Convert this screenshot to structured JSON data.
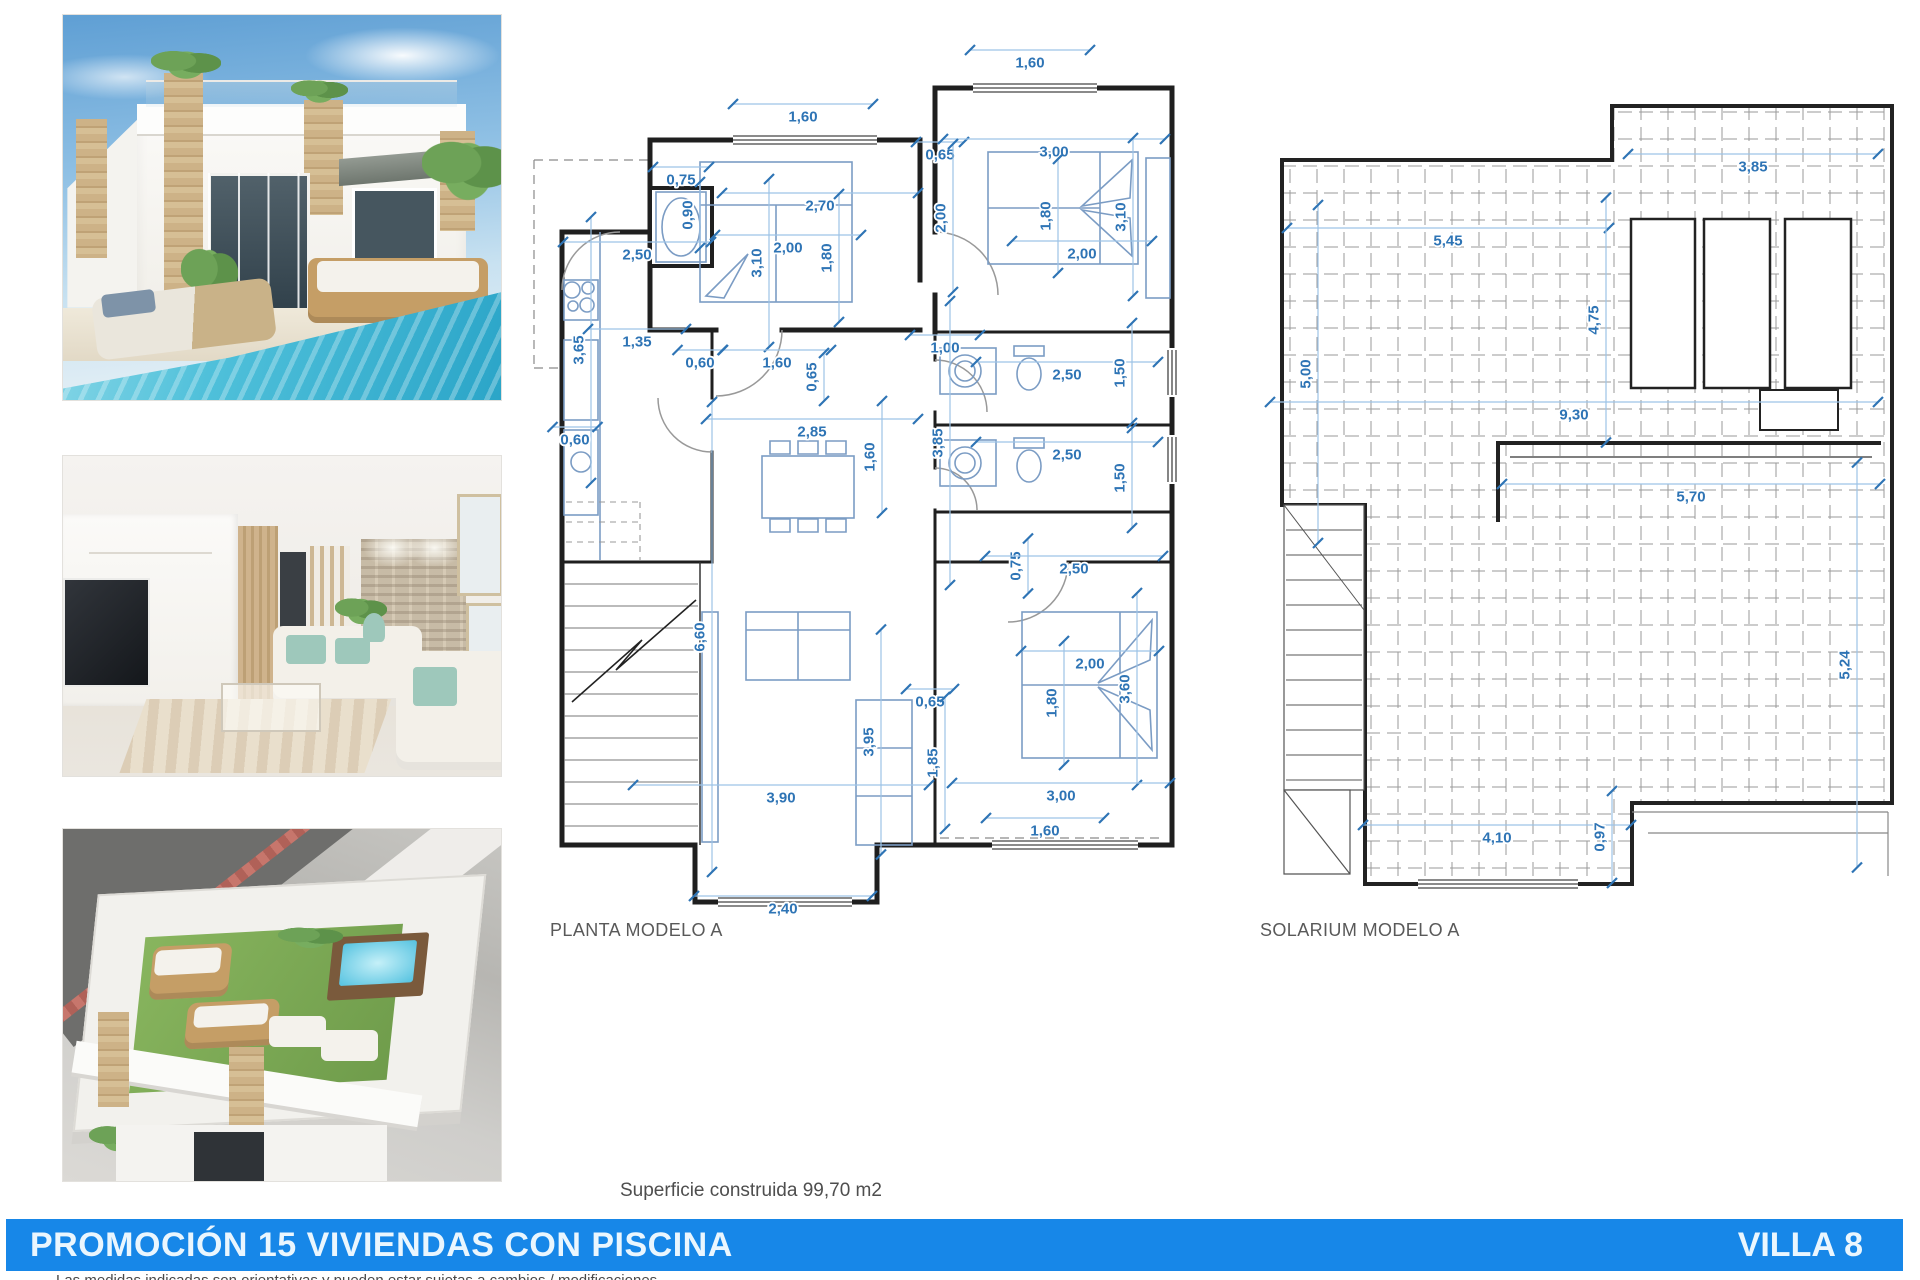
{
  "planta": {
    "label": "PLANTA MODELO A",
    "dims": [
      {
        "v": "1,60",
        "x": 803,
        "y": 117,
        "r": 0,
        "len": 140
      },
      {
        "v": "1,60",
        "x": 1030,
        "y": 63,
        "r": 0,
        "len": 120
      },
      {
        "v": "0,75",
        "x": 681,
        "y": 180,
        "r": 0,
        "len": 56
      },
      {
        "v": "0,90",
        "x": 688,
        "y": 215,
        "r": 1,
        "len": 66
      },
      {
        "v": "2,70",
        "x": 820,
        "y": 206,
        "r": 0,
        "len": 196
      },
      {
        "v": "2,00",
        "x": 788,
        "y": 248,
        "r": 0,
        "len": 146
      },
      {
        "v": "3,10",
        "x": 757,
        "y": 263,
        "r": 1,
        "len": 168
      },
      {
        "v": "1,80",
        "x": 827,
        "y": 258,
        "r": 1,
        "len": 128
      },
      {
        "v": "0,65",
        "x": 940,
        "y": 155,
        "r": 0,
        "len": 48
      },
      {
        "v": "3,00",
        "x": 1054,
        "y": 152,
        "r": 0,
        "len": 222
      },
      {
        "v": "2,00",
        "x": 941,
        "y": 218,
        "r": 1,
        "len": 148
      },
      {
        "v": "1,80",
        "x": 1046,
        "y": 216,
        "r": 1,
        "len": 114
      },
      {
        "v": "3,10",
        "x": 1121,
        "y": 217,
        "r": 1,
        "len": 158
      },
      {
        "v": "2,00",
        "x": 1082,
        "y": 254,
        "r": 0,
        "len": 140
      },
      {
        "v": "2,50",
        "x": 637,
        "y": 255,
        "r": 0,
        "len": 148
      },
      {
        "v": "3,65",
        "x": 579,
        "y": 350,
        "r": 1,
        "len": 266
      },
      {
        "v": "1,35",
        "x": 637,
        "y": 342,
        "r": 0,
        "len": 98
      },
      {
        "v": "0,60",
        "x": 700,
        "y": 363,
        "r": 0,
        "len": 45
      },
      {
        "v": "1,60",
        "x": 777,
        "y": 363,
        "r": 0,
        "len": 108
      },
      {
        "v": "0,65",
        "x": 812,
        "y": 377,
        "r": 1,
        "len": 48
      },
      {
        "v": "1,00",
        "x": 945,
        "y": 348,
        "r": 0,
        "len": 70
      },
      {
        "v": "2,85",
        "x": 812,
        "y": 432,
        "r": 0,
        "len": 212
      },
      {
        "v": "1,60",
        "x": 870,
        "y": 457,
        "r": 1,
        "len": 112
      },
      {
        "v": "3,85",
        "x": 938,
        "y": 443,
        "r": 1,
        "len": 284
      },
      {
        "v": "0,60",
        "x": 575,
        "y": 440,
        "r": 0,
        "len": 45
      },
      {
        "v": "2,50",
        "x": 1067,
        "y": 375,
        "r": 0,
        "len": 182
      },
      {
        "v": "1,50",
        "x": 1120,
        "y": 373,
        "r": 1,
        "len": 100
      },
      {
        "v": "2,50",
        "x": 1067,
        "y": 455,
        "r": 0,
        "len": 182
      },
      {
        "v": "1,50",
        "x": 1120,
        "y": 478,
        "r": 1,
        "len": 100
      },
      {
        "v": "0,75",
        "x": 1016,
        "y": 566,
        "r": 1,
        "len": 55
      },
      {
        "v": "2,50",
        "x": 1074,
        "y": 569,
        "r": 0,
        "len": 178
      },
      {
        "v": "6,60",
        "x": 700,
        "y": 637,
        "r": 1,
        "len": 470
      },
      {
        "v": "2,00",
        "x": 1090,
        "y": 664,
        "r": 0,
        "len": 138
      },
      {
        "v": "3,60",
        "x": 1125,
        "y": 689,
        "r": 1,
        "len": 192
      },
      {
        "v": "1,80",
        "x": 1052,
        "y": 703,
        "r": 1,
        "len": 124
      },
      {
        "v": "0,65",
        "x": 930,
        "y": 702,
        "r": 0,
        "len": 48
      },
      {
        "v": "3,95",
        "x": 869,
        "y": 742,
        "r": 1,
        "len": 225
      },
      {
        "v": "1,85",
        "x": 933,
        "y": 763,
        "r": 1,
        "len": 132
      },
      {
        "v": "3,00",
        "x": 1061,
        "y": 796,
        "r": 0,
        "len": 218
      },
      {
        "v": "3,90",
        "x": 781,
        "y": 798,
        "r": 0,
        "len": 296
      },
      {
        "v": "1,60",
        "x": 1045,
        "y": 831,
        "r": 0,
        "len": 118
      },
      {
        "v": "2,40",
        "x": 783,
        "y": 909,
        "r": 0,
        "len": 178
      }
    ]
  },
  "solarium": {
    "label": "SOLARIUM MODELO A",
    "dims": [
      {
        "v": "3,85",
        "x": 1753,
        "y": 167,
        "r": 0,
        "len": 250
      },
      {
        "v": "5,45",
        "x": 1448,
        "y": 241,
        "r": 0,
        "len": 322
      },
      {
        "v": "5,00",
        "x": 1306,
        "y": 374,
        "r": 1,
        "len": 338
      },
      {
        "v": "4,75",
        "x": 1594,
        "y": 320,
        "r": 1,
        "len": 245
      },
      {
        "v": "9,30",
        "x": 1574,
        "y": 415,
        "r": 0,
        "len": 608
      },
      {
        "v": "5,70",
        "x": 1691,
        "y": 497,
        "r": 0,
        "len": 378
      },
      {
        "v": "5,24",
        "x": 1845,
        "y": 665,
        "r": 1,
        "len": 405
      },
      {
        "v": "4,10",
        "x": 1497,
        "y": 838,
        "r": 0,
        "len": 268
      },
      {
        "v": "0,97",
        "x": 1600,
        "y": 837,
        "r": 1,
        "len": 92
      }
    ]
  },
  "area_note": "Superficie construida 99,70 m2",
  "banner": {
    "title": "PROMOCIÓN 15 VIVIENDAS CON PISCINA",
    "villa": "VILLA 8"
  },
  "disclaimer": "Las medidas indicadas son orientativas y pueden estar sujetas a cambios / modificaciones",
  "colors": {
    "dim_blue": "#2e74b5",
    "banner_blue": "#1787e8",
    "wall": "#1f1f1f",
    "furniture": "#7b9cc4"
  }
}
